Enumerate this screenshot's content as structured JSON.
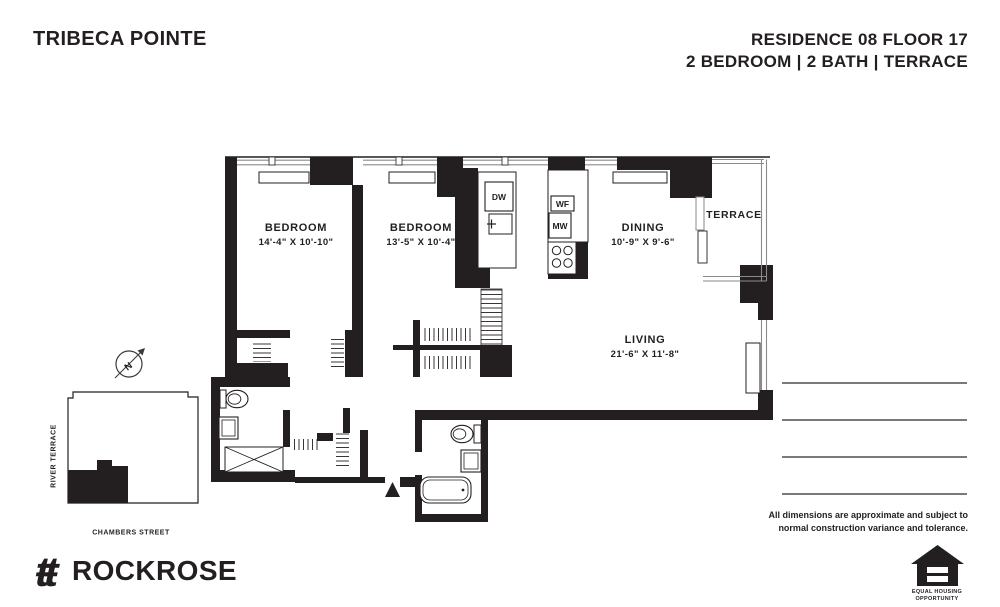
{
  "header": {
    "title": "TRIBECA POINTE",
    "residence": "RESIDENCE 08 FLOOR 17",
    "unit_info": "2 BEDROOM | 2 BATH | TERRACE"
  },
  "floorplan": {
    "rooms": [
      {
        "name": "BEDROOM",
        "dims": "14'-4\" X 10'-10\""
      },
      {
        "name": "BEDROOM",
        "dims": "13'-5\" X 10'-4\""
      },
      {
        "name": "DINING",
        "dims": "10'-9\" X 9'-6\""
      },
      {
        "name": "LIVING",
        "dims": "21'-6\" X 11'-8\""
      },
      {
        "name": "TERRACE",
        "dims": ""
      }
    ],
    "appliances": [
      {
        "label": "DW"
      },
      {
        "label": "WF"
      },
      {
        "label": "MW"
      }
    ]
  },
  "siteplan": {
    "street_left": "RIVER TERRACE",
    "street_bottom": "CHAMBERS STREET",
    "compass_n": "N"
  },
  "footer": {
    "brand": "ROCKROSE",
    "brand_mark": "ŧŧ",
    "disclaimer_line1": "All dimensions are approximate and subject to",
    "disclaimer_line2": "normal construction variance and tolerance.",
    "equal_housing_line1": "EQUAL HOUSING",
    "equal_housing_line2": "OPPORTUNITY"
  },
  "colors": {
    "ink": "#231f20",
    "line_gray": "#4d4d4d",
    "window_gray": "#8a8a8a"
  }
}
